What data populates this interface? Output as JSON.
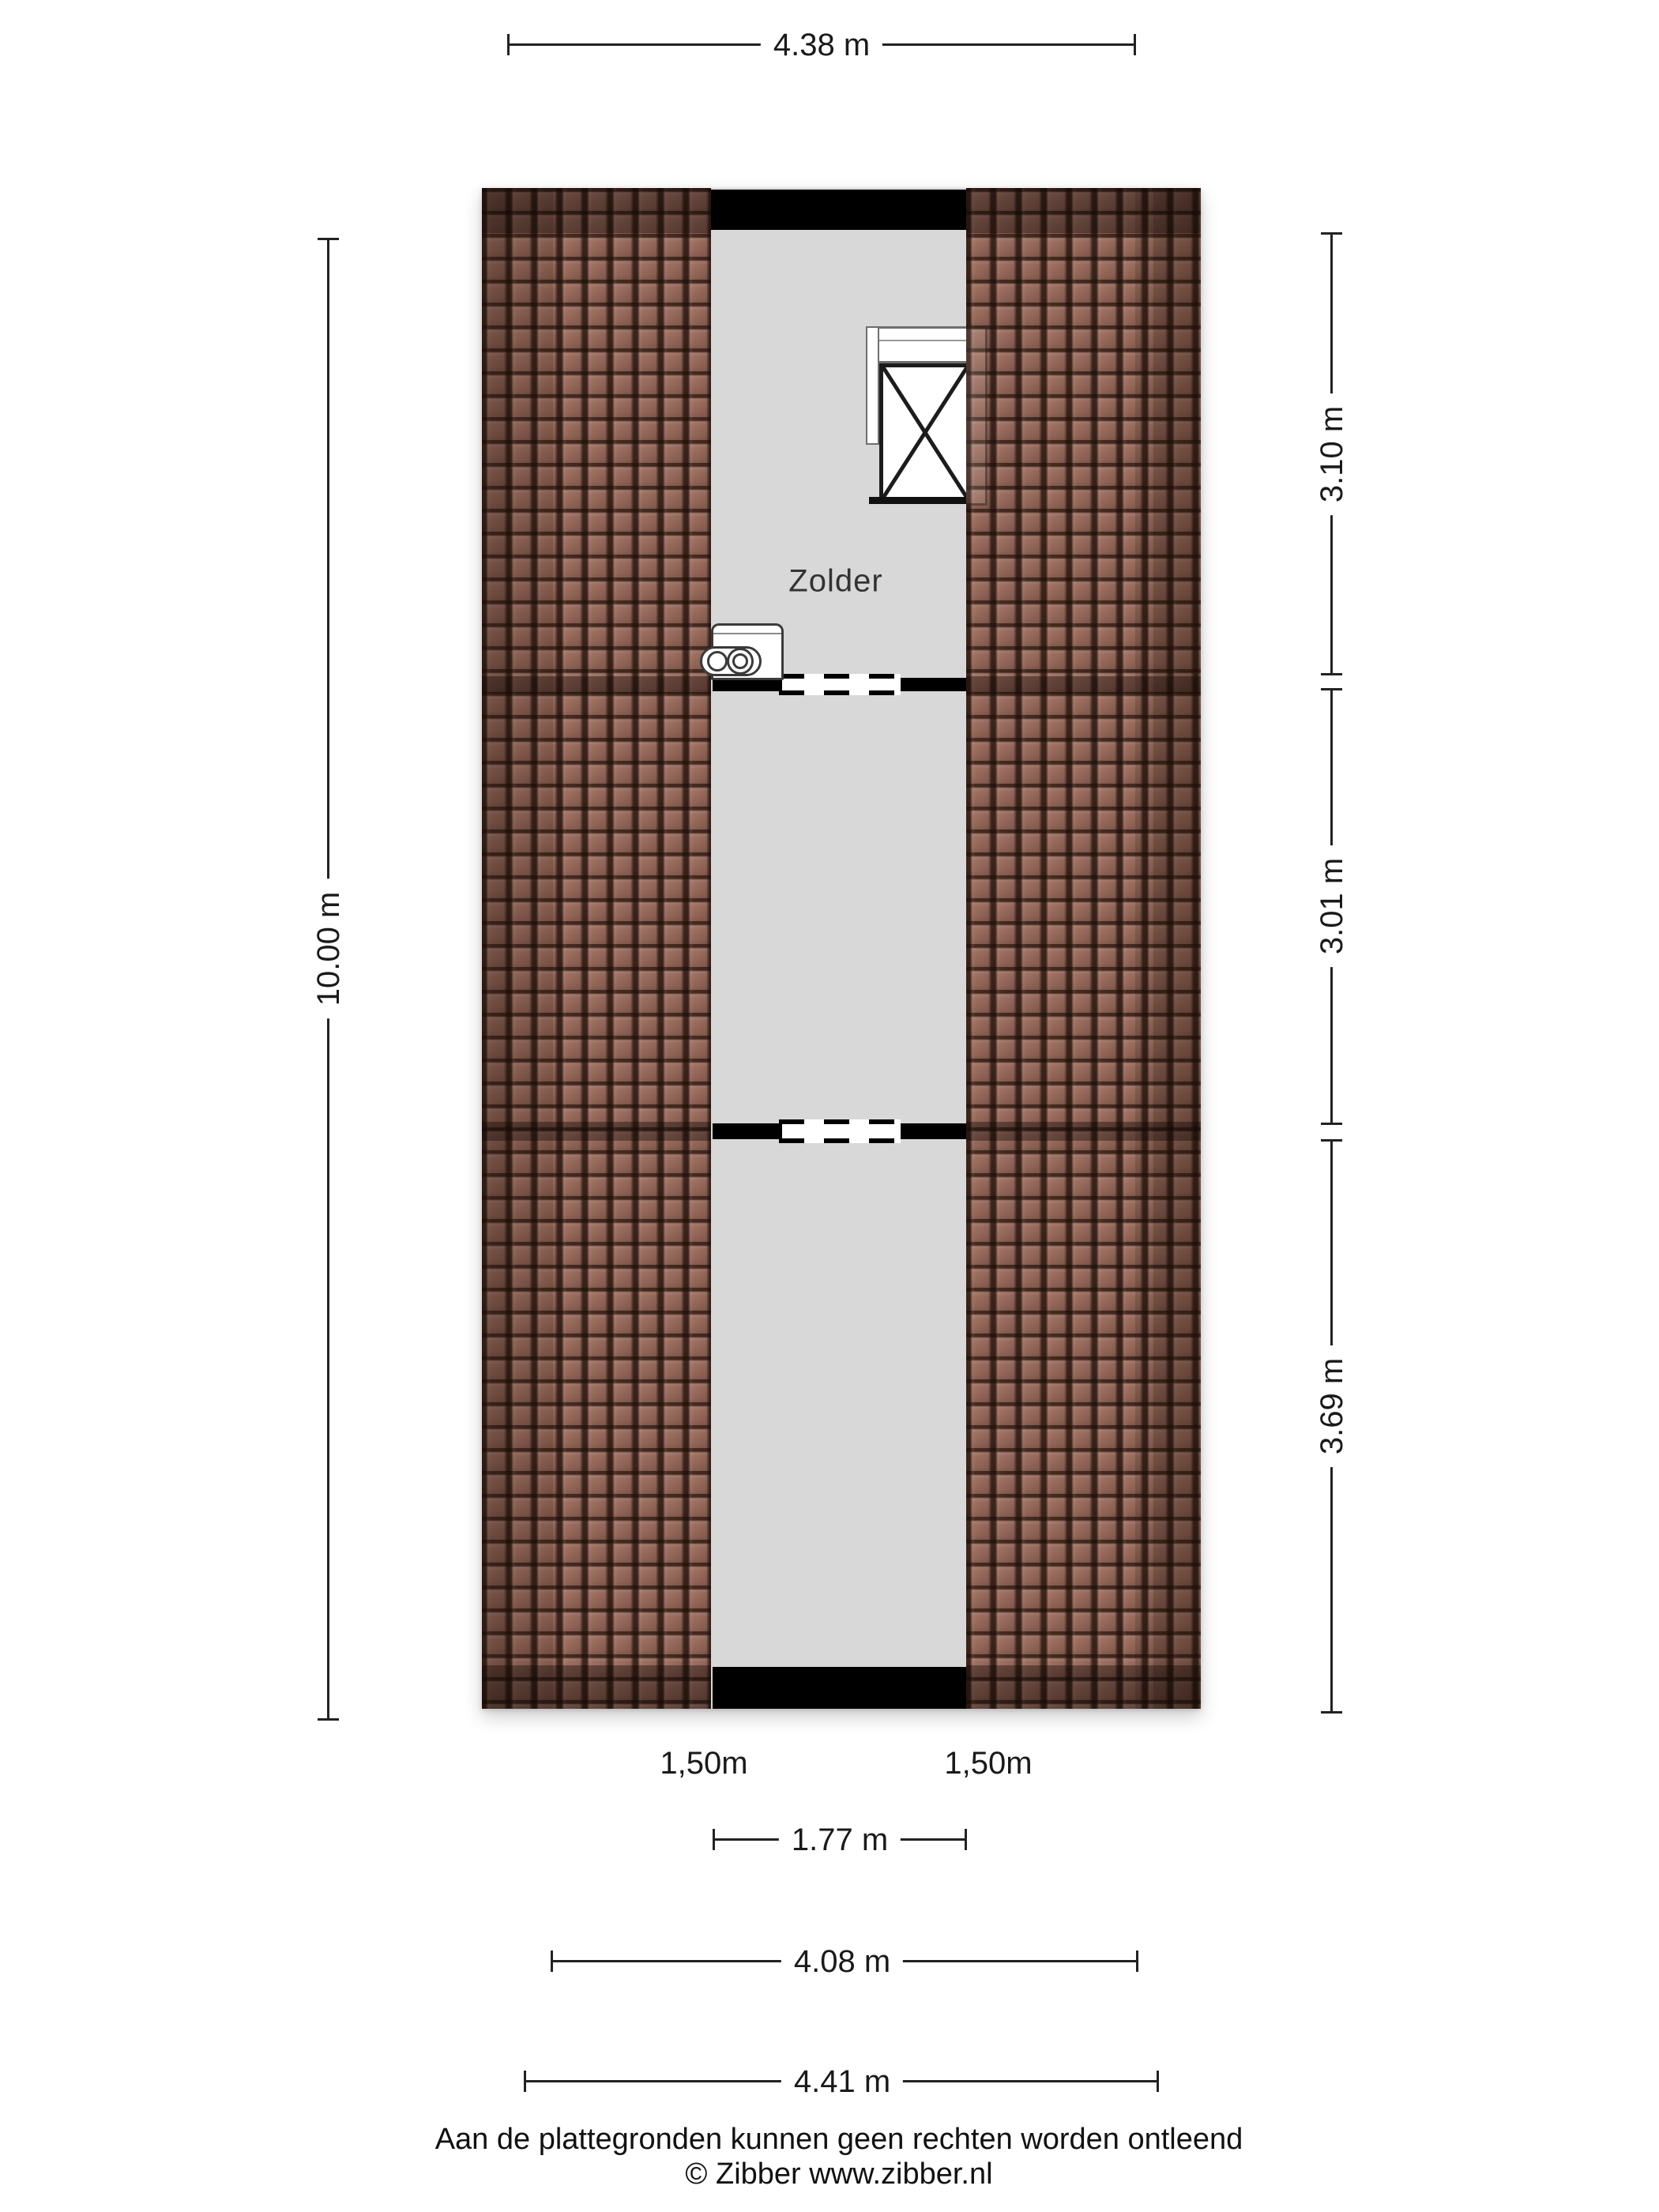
{
  "plan": {
    "room_label": "Zolder"
  },
  "dimensions": {
    "top_width": "4.38 m",
    "left_height": "10.00 m",
    "right_top": "3.10 m",
    "right_middle": "3.01 m",
    "right_bottom": "3.69 m",
    "clearance_left": "1,50m",
    "clearance_right": "1,50m",
    "inner_width": "1.77 m",
    "floor_width": "4.08 m",
    "outer_width": "4.41 m"
  },
  "footer": {
    "disclaimer": "Aan de plattegronden kunnen geen rechten worden ontleend",
    "copyright": "© Zibber www.zibber.nl"
  },
  "colors": {
    "roof-base": "#9a6a5b",
    "floor-gray": "#d8d8d8",
    "wall-black": "#000000",
    "dim-ink": "#1a1a1a"
  }
}
